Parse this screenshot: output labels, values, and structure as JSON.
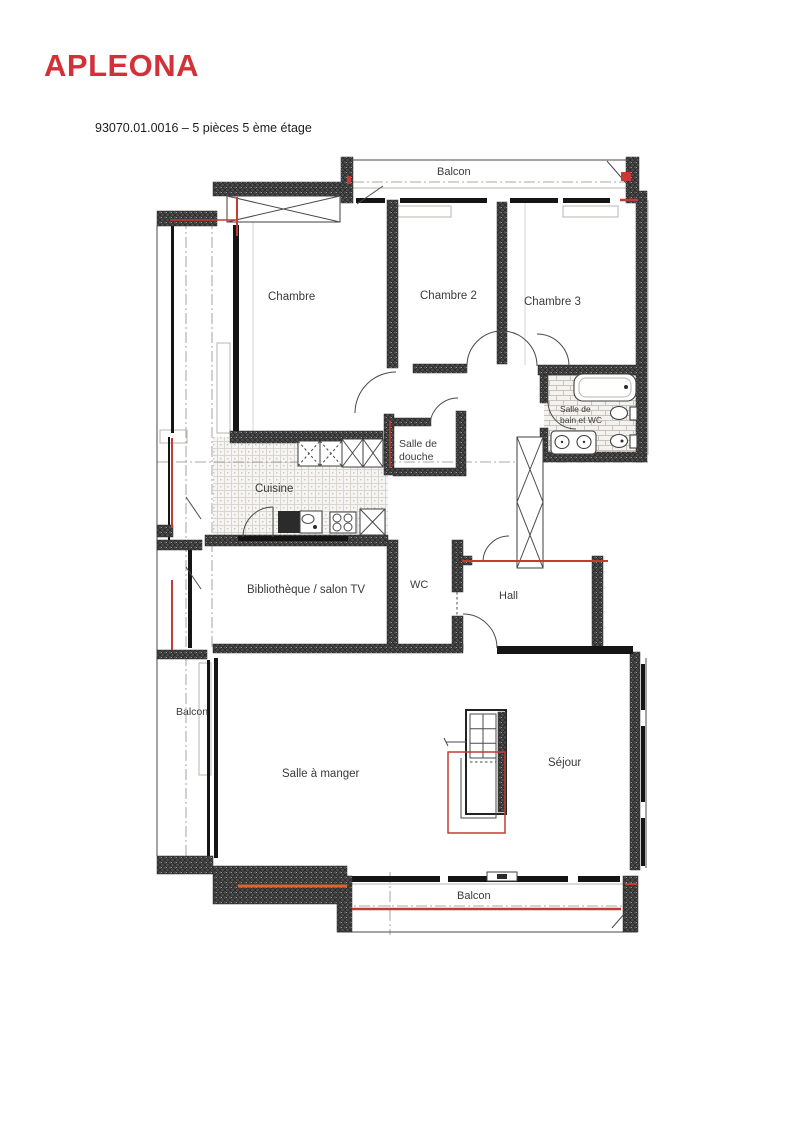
{
  "colors": {
    "brand": "#D13239",
    "red": "#C23B35",
    "orange": "#E2622B",
    "wall": "#4A4A4A",
    "ink": "#3A3A3A"
  },
  "header": {
    "logo": "APLEONA",
    "title": "93070.01.0016 – 5 pièces 5 ème étage"
  },
  "floorplan": {
    "rooms": {
      "balcon_top": {
        "label": "Balcon"
      },
      "chambre": {
        "label": "Chambre"
      },
      "chambre_2": {
        "label": "Chambre 2"
      },
      "chambre_3": {
        "label": "Chambre 3"
      },
      "salle_de_bain": {
        "line1": "Salle de",
        "line2": "bain et WC"
      },
      "salle_de_douche": {
        "line1": "Salle de",
        "line2": "douche"
      },
      "cuisine": {
        "label": "Cuisine"
      },
      "bibliotheque": {
        "label": "Bibliothèque / salon TV"
      },
      "wc": {
        "label": "WC"
      },
      "hall": {
        "label": "Hall"
      },
      "balcon_left": {
        "label": "Balcon"
      },
      "salle_a_manger": {
        "label": "Salle à manger"
      },
      "sejour": {
        "label": "Séjour"
      },
      "balcon_bottom": {
        "label": "Balcon"
      }
    }
  }
}
